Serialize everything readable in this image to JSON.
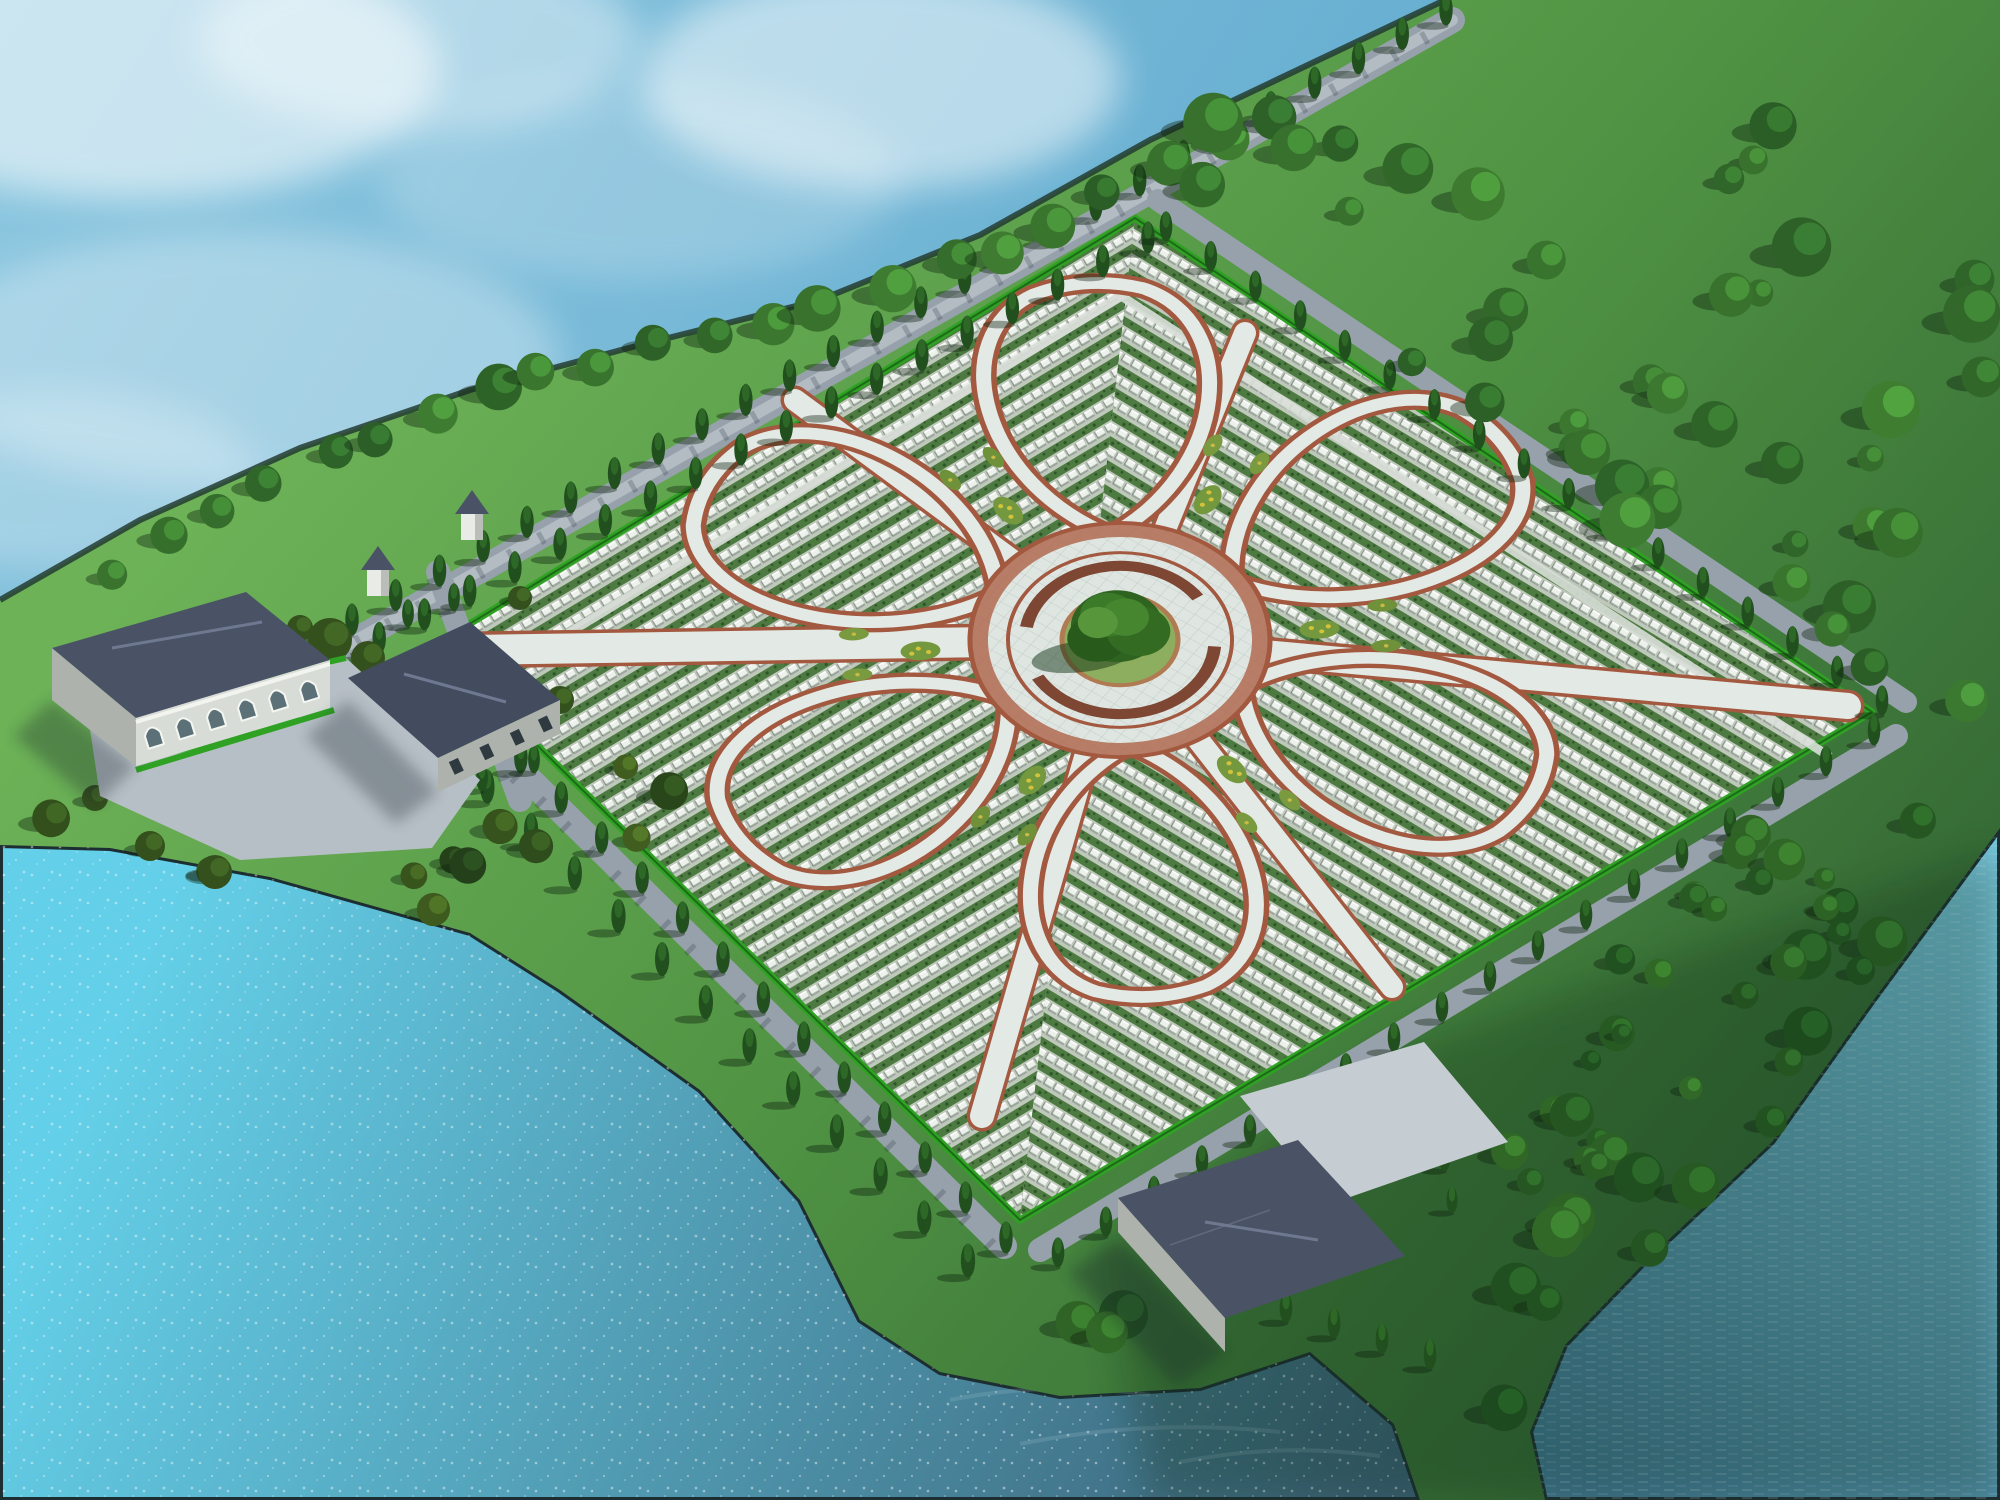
{
  "meta": {
    "canvas": {
      "w": 2000,
      "h": 1500
    }
  },
  "palette": {
    "water_top": [
      "#8ec8e0",
      "#5aa6cc"
    ],
    "water_lower": [
      "#64cfe8",
      "#3a5f74"
    ],
    "water_inlet": [
      "#78c8de",
      "#3f7691"
    ],
    "shore_edge": "#1d2e33",
    "land_gradient": [
      "#6db257",
      "#4f9243",
      "#2b5a30"
    ],
    "hedge": "#2fa224",
    "hedge_dark": "#1d6a18",
    "road": "#97a1ab",
    "road_stripe": "#b3bbc3",
    "road_shadow": "#1b2830",
    "path_pale": "#e3e9e5",
    "path_edge": "#a2593f",
    "grave_base": "#bfc9bb",
    "grave_shrub": "#4c7a40",
    "grave_shrub_dark": "#2f5429",
    "stone": "#edf1ec",
    "stone_shadow": "#8b968d",
    "stone_side": "#39443c",
    "plaza": "#dfe6e2",
    "plaza_grid": "#c3cdc7",
    "ring_band": "#b06a50",
    "ring_wall": "#7e4733",
    "mound": "#8cae5e",
    "mound_rim": "#b07a52",
    "cypress_body": "#214f1e",
    "cypress_tip": "#2f6a28",
    "tree_shadow": "#0e2410",
    "roof": "#4a5365",
    "roof_dark": "#434c5e",
    "roof_line": "#6e7890",
    "wall": "#d8dcd6",
    "wall_shade": "#aeb2ac",
    "glass": "#5c7078",
    "building_shadow": "#16242c",
    "plaza_stone": "#b7bfc6",
    "boat_hull": "#7a5638",
    "boat_trim": "#c9a878",
    "bird": "#ffffff",
    "fog": "#eef7f5",
    "cloud": "#ffffff"
  },
  "water": {
    "lower_polygon": [
      [
        0,
        845
      ],
      [
        110,
        848
      ],
      [
        270,
        877
      ],
      [
        470,
        933
      ],
      [
        560,
        990
      ],
      [
        700,
        1090
      ],
      [
        800,
        1200
      ],
      [
        860,
        1320
      ],
      [
        940,
        1372
      ],
      [
        1060,
        1396
      ],
      [
        1200,
        1388
      ],
      [
        1310,
        1352
      ],
      [
        1394,
        1424
      ],
      [
        1420,
        1500
      ],
      [
        0,
        1500
      ]
    ],
    "inlet_polygon": [
      [
        2000,
        828
      ],
      [
        1872,
        1002
      ],
      [
        1772,
        1142
      ],
      [
        1645,
        1262
      ],
      [
        1565,
        1345
      ],
      [
        1530,
        1432
      ],
      [
        1545,
        1500
      ],
      [
        2000,
        1500
      ]
    ],
    "wave_streaks": [
      [
        [
          950,
          1400
        ],
        [
          1050,
          1380
        ],
        [
          1150,
          1395
        ]
      ],
      [
        [
          1020,
          1444
        ],
        [
          1150,
          1418
        ],
        [
          1280,
          1432
        ]
      ],
      [
        [
          900,
          1350
        ],
        [
          980,
          1335
        ],
        [
          1060,
          1345
        ]
      ],
      [
        [
          1180,
          1462
        ],
        [
          1280,
          1442
        ],
        [
          1380,
          1456
        ]
      ]
    ]
  },
  "clouds": [
    [
      140,
      70,
      300,
      130,
      0.55
    ],
    [
      420,
      40,
      220,
      90,
      0.4
    ],
    [
      880,
      80,
      240,
      110,
      0.5
    ],
    [
      240,
      360,
      320,
      130,
      0.3
    ],
    [
      60,
      480,
      200,
      90,
      0.25
    ],
    [
      640,
      180,
      260,
      100,
      0.2
    ]
  ],
  "fog": [
    [
      1640,
      120,
      420,
      150,
      0.85
    ],
    [
      1900,
      330,
      320,
      230,
      0.8
    ],
    [
      1520,
      460,
      300,
      140,
      0.5
    ],
    [
      1300,
      60,
      260,
      90,
      0.55
    ],
    [
      1000,
      30,
      220,
      60,
      0.3
    ],
    [
      1780,
      700,
      280,
      120,
      0.35
    ],
    [
      1560,
      250,
      340,
      180,
      0.6
    ]
  ],
  "land": {
    "polygon": [
      [
        1445,
        0
      ],
      [
        1310,
        64
      ],
      [
        1150,
        140
      ],
      [
        980,
        235
      ],
      [
        820,
        300
      ],
      [
        640,
        345
      ],
      [
        470,
        390
      ],
      [
        300,
        448
      ],
      [
        140,
        520
      ],
      [
        0,
        600
      ],
      [
        0,
        845
      ],
      [
        110,
        848
      ],
      [
        270,
        877
      ],
      [
        470,
        933
      ],
      [
        560,
        990
      ],
      [
        700,
        1090
      ],
      [
        800,
        1200
      ],
      [
        860,
        1320
      ],
      [
        940,
        1372
      ],
      [
        1060,
        1396
      ],
      [
        1200,
        1388
      ],
      [
        1310,
        1352
      ],
      [
        1394,
        1424
      ],
      [
        1420,
        1500
      ],
      [
        1545,
        1500
      ],
      [
        1530,
        1432
      ],
      [
        1565,
        1345
      ],
      [
        1645,
        1262
      ],
      [
        1772,
        1142
      ],
      [
        1872,
        1002
      ],
      [
        2000,
        828
      ],
      [
        2000,
        0
      ]
    ],
    "upper_shoreline": [
      [
        1445,
        0
      ],
      [
        1310,
        64
      ],
      [
        1150,
        140
      ],
      [
        980,
        235
      ],
      [
        820,
        300
      ],
      [
        640,
        345
      ],
      [
        470,
        390
      ],
      [
        300,
        448
      ],
      [
        140,
        520
      ],
      [
        0,
        600
      ]
    ],
    "se_dark_overlay": [
      [
        1150,
        1500
      ],
      [
        1100,
        1250
      ],
      [
        1400,
        1050
      ],
      [
        2000,
        850
      ],
      [
        2000,
        1500
      ]
    ]
  },
  "field": {
    "corners": {
      "T": [
        1135,
        218
      ],
      "R": [
        1872,
        712
      ],
      "B": [
        1020,
        1220
      ],
      "L": [
        435,
        645
      ]
    },
    "pattern_angles": [
      -31,
      31
    ],
    "section_paths": [
      [
        536,
        653,
        1131,
        290
      ],
      [
        1115,
        292,
        1830,
        757
      ]
    ]
  },
  "flower": {
    "center": [
      1120,
      640
    ],
    "rotate": -10,
    "squash": 0.78,
    "petal_angles": [
      36,
      96,
      156,
      216,
      276,
      336
    ],
    "gap_angles": [
      6,
      66,
      126,
      186,
      246,
      306
    ],
    "petal_path": "M135 0 C210 -125 400 -150 448 -55 C462 -18 462 18 448 55 C400 150 210 125 135 0 Z",
    "plaza_r": 150,
    "ring_band_r": 141,
    "inner_ring_r": 112,
    "bench_r": 95,
    "mound_r": 58,
    "bed_r1": 200,
    "bed_r2": 265,
    "tree_circles": [
      [
        0,
        -18,
        46,
        "#2f6320"
      ],
      [
        -22,
        -6,
        30,
        "#285a1c"
      ],
      [
        20,
        -8,
        32,
        "#336b22"
      ],
      [
        -6,
        -34,
        28,
        "#3b7a28"
      ],
      [
        10,
        -28,
        24,
        "#46862e"
      ],
      [
        -18,
        -26,
        20,
        "#57963a"
      ]
    ],
    "tree_shadow": [
      -40,
      14,
      52,
      20
    ]
  },
  "radial_paths": [
    [
      470,
      650,
      30
    ],
    [
      795,
      400,
      22
    ],
    [
      1245,
      333,
      22
    ],
    [
      1848,
      706,
      26
    ],
    [
      1392,
      987,
      22
    ],
    [
      982,
      1116,
      24
    ]
  ],
  "roads": [
    {
      "name": "nw-perimeter-road",
      "pts": [
        [
          332,
          654
        ],
        [
          1452,
          20
        ]
      ],
      "w": 26,
      "stripe": true,
      "shadow": true
    },
    {
      "name": "entrance-spur-road",
      "pts": [
        [
          438,
          572
        ],
        [
          520,
          800
        ]
      ],
      "w": 24,
      "stripe": false,
      "shadow": true
    },
    {
      "name": "sw-shore-road",
      "pts": [
        [
          420,
          672
        ],
        [
          1004,
          1246
        ]
      ],
      "w": 26,
      "stripe": false,
      "shadow": true
    },
    {
      "name": "se-perimeter-road",
      "pts": [
        [
          1040,
          1250
        ],
        [
          1896,
          736
        ]
      ],
      "w": 24,
      "stripe": false,
      "shadow": false
    },
    {
      "name": "ne-perimeter-road",
      "pts": [
        [
          1158,
          200
        ],
        [
          1906,
          702
        ]
      ],
      "w": 22,
      "stripe": false,
      "shadow": false
    },
    {
      "name": "pavilion-link-road",
      "pts": [
        [
          1292,
          1212
        ],
        [
          1342,
          1118
        ]
      ],
      "w": 22,
      "stripe": false,
      "shadow": false
    }
  ],
  "cypress_rows": [
    [
      352,
      634,
      1446,
      24,
      26,
      32
    ],
    [
      334,
      676,
      1148,
      252,
      19,
      32
    ],
    [
      1166,
      240,
      1882,
      714,
      17,
      30
    ],
    [
      1874,
      744,
      1058,
      1266,
      18,
      30
    ],
    [
      440,
      692,
      1006,
      1252,
      15,
      32
    ],
    [
      400,
      716,
      968,
      1276,
      14,
      34
    ],
    [
      408,
      626,
      482,
      790,
      4,
      28
    ],
    [
      454,
      610,
      534,
      772,
      4,
      28
    ],
    [
      1238,
      1306,
      1430,
      1368,
      5,
      30
    ],
    [
      1430,
      1086,
      1452,
      1212,
      4,
      26
    ]
  ],
  "shore_trees": {
    "pts": [
      [
        120,
        560
      ],
      [
        260,
        478
      ],
      [
        420,
        408
      ],
      [
        600,
        352
      ],
      [
        800,
        308
      ],
      [
        1000,
        242
      ],
      [
        1180,
        156
      ],
      [
        1320,
        78
      ]
    ],
    "spacing": 57,
    "r": [
      15,
      24
    ],
    "seed": 7,
    "colors": [
      "#2a5d26",
      "#3f7d31"
    ]
  },
  "meadows": [
    {
      "poly": [
        [
          1210,
          120
        ],
        [
          1995,
          60
        ],
        [
          1995,
          800
        ],
        [
          1890,
          700
        ],
        [
          1160,
          215
        ]
      ],
      "n": 42,
      "seed": 11,
      "r": [
        12,
        30
      ],
      "colors": [
        "#2a5d26",
        "#3f7d31"
      ],
      "exclude": []
    },
    {
      "poly": [
        [
          1080,
          1280
        ],
        [
          1880,
          748
        ],
        [
          1975,
          840
        ],
        [
          1860,
          1010
        ],
        [
          1760,
          1148
        ],
        [
          1630,
          1268
        ],
        [
          1548,
          1352
        ],
        [
          1505,
          1430
        ],
        [
          1420,
          1440
        ],
        [
          1315,
          1350
        ],
        [
          1180,
          1385
        ],
        [
          1010,
          1360
        ]
      ],
      "n": 46,
      "seed": 23,
      "r": [
        10,
        26
      ],
      "colors": [
        "#1d4a1e",
        "#326927"
      ],
      "exclude": [
        [
          1300,
          1230,
          150
        ],
        [
          1400,
          1120,
          95
        ]
      ]
    },
    {
      "poly": [
        [
          0,
          630
        ],
        [
          240,
          655
        ],
        [
          420,
          760
        ],
        [
          600,
          862
        ],
        [
          556,
          948
        ],
        [
          300,
          912
        ],
        [
          0,
          852
        ]
      ],
      "n": 12,
      "seed": 5,
      "r": [
        11,
        22
      ],
      "colors": [
        "#23401a",
        "#44601f"
      ],
      "exclude": []
    },
    {
      "poly": [
        [
          520,
          700
        ],
        [
          700,
          800
        ],
        [
          640,
          900
        ],
        [
          470,
          820
        ]
      ],
      "n": 5,
      "seed": 9,
      "r": [
        12,
        20
      ],
      "colors": [
        "#23401a",
        "#44601f"
      ],
      "exclude": []
    }
  ],
  "left_trees": [
    [
      330,
      640,
      22
    ],
    [
      368,
      658,
      17
    ],
    [
      300,
      628,
      13
    ],
    [
      520,
      598,
      12
    ],
    [
      150,
      846,
      15
    ],
    [
      215,
      872,
      17
    ],
    [
      95,
      798,
      13
    ],
    [
      560,
      700,
      14
    ]
  ],
  "buildings": {
    "left_plaza": [
      [
        88,
        716
      ],
      [
        346,
        658
      ],
      [
        480,
        780
      ],
      [
        432,
        848
      ],
      [
        240,
        860
      ],
      [
        100,
        796
      ]
    ],
    "plaza_hedges": [
      [
        [
          88,
          716
        ],
        [
          346,
          658
        ]
      ],
      [
        [
          140,
          760
        ],
        [
          300,
          720
        ]
      ],
      [
        [
          136,
          770
        ],
        [
          334,
          710
        ]
      ]
    ],
    "b1_shadow": [
      [
        52,
        700
      ],
      [
        136,
        766
      ],
      [
        96,
        806
      ],
      [
        14,
        736
      ]
    ],
    "b1_gable": [
      [
        52,
        648
      ],
      [
        136,
        718
      ],
      [
        136,
        766
      ],
      [
        52,
        700
      ]
    ],
    "b1_roof": [
      [
        52,
        648
      ],
      [
        246,
        592
      ],
      [
        330,
        660
      ],
      [
        136,
        718
      ]
    ],
    "b1_ridge": [
      [
        112,
        648
      ],
      [
        262,
        622
      ]
    ],
    "b1_facade": [
      [
        136,
        718
      ],
      [
        330,
        660
      ],
      [
        330,
        708
      ],
      [
        136,
        766
      ]
    ],
    "b1_arch_line": [
      [
        136,
        742
      ],
      [
        330,
        684
      ]
    ],
    "b1_arch_ts": [
      0.09,
      0.25,
      0.41,
      0.57,
      0.73,
      0.89
    ],
    "b2_shadow": [
      [
        348,
        700
      ],
      [
        438,
        792
      ],
      [
        396,
        824
      ],
      [
        306,
        736
      ]
    ],
    "b2_roof": [
      [
        348,
        678
      ],
      [
        470,
        622
      ],
      [
        560,
        700
      ],
      [
        438,
        758
      ]
    ],
    "b2_ridge": [
      [
        404,
        674
      ],
      [
        506,
        702
      ]
    ],
    "b2_facade": [
      [
        438,
        758
      ],
      [
        560,
        700
      ],
      [
        560,
        734
      ],
      [
        438,
        792
      ]
    ],
    "b2_win_line": [
      [
        438,
        775
      ],
      [
        560,
        717
      ]
    ],
    "b2_win_ts": [
      0.15,
      0.4,
      0.65,
      0.88
    ],
    "plaza3": [
      [
        1240,
        1096
      ],
      [
        1424,
        1042
      ],
      [
        1508,
        1142
      ],
      [
        1330,
        1204
      ]
    ],
    "b3_shadow": [
      [
        1118,
        1240
      ],
      [
        1225,
        1352
      ],
      [
        1176,
        1386
      ],
      [
        1068,
        1272
      ]
    ],
    "b3_gable": [
      [
        1118,
        1198
      ],
      [
        1225,
        1318
      ],
      [
        1225,
        1352
      ],
      [
        1118,
        1232
      ]
    ],
    "b3_roof": [
      [
        1118,
        1198
      ],
      [
        1298,
        1140
      ],
      [
        1405,
        1256
      ],
      [
        1225,
        1318
      ]
    ],
    "b3_ridge": [
      [
        1205,
        1222
      ],
      [
        1318,
        1240
      ]
    ],
    "b3_facade": [
      [
        1225,
        1318
      ],
      [
        1405,
        1256
      ],
      [
        1405,
        1288
      ],
      [
        1225,
        1352
      ]
    ],
    "b3_win_line": [
      [
        1225,
        1335
      ],
      [
        1405,
        1272
      ]
    ],
    "b3_win_ts": [
      0.1,
      0.3,
      0.5,
      0.7,
      0.9
    ],
    "courtyard_outer": [
      [
        1360,
        1128
      ],
      [
        1424,
        1112
      ],
      [
        1440,
        1158
      ],
      [
        1376,
        1176
      ]
    ],
    "courtyard_inner": [
      [
        1382,
        1136
      ],
      [
        1416,
        1128
      ],
      [
        1426,
        1154
      ],
      [
        1392,
        1163
      ]
    ]
  },
  "towers": [
    [
      378,
      588
    ],
    [
      472,
      532
    ]
  ],
  "boats": [
    [
      205,
      436,
      1,
      -4
    ],
    [
      296,
      450,
      0.8,
      -3
    ],
    [
      309,
      396,
      0.62,
      -6
    ]
  ],
  "birds": [
    [
      1498,
      1102,
      0.8,
      -8
    ],
    [
      1556,
      1134,
      0.95,
      4
    ],
    [
      1612,
      1094,
      0.65,
      -12
    ],
    [
      1668,
      1062,
      0.75,
      6
    ],
    [
      1708,
      1104,
      0.85,
      -4
    ],
    [
      1596,
      1198,
      0.7,
      10
    ],
    [
      1646,
      1244,
      0.95,
      -6
    ],
    [
      1706,
      1212,
      0.8,
      8
    ],
    [
      1764,
      1162,
      0.7,
      -10
    ],
    [
      1820,
      1040,
      0.55,
      5
    ]
  ]
}
